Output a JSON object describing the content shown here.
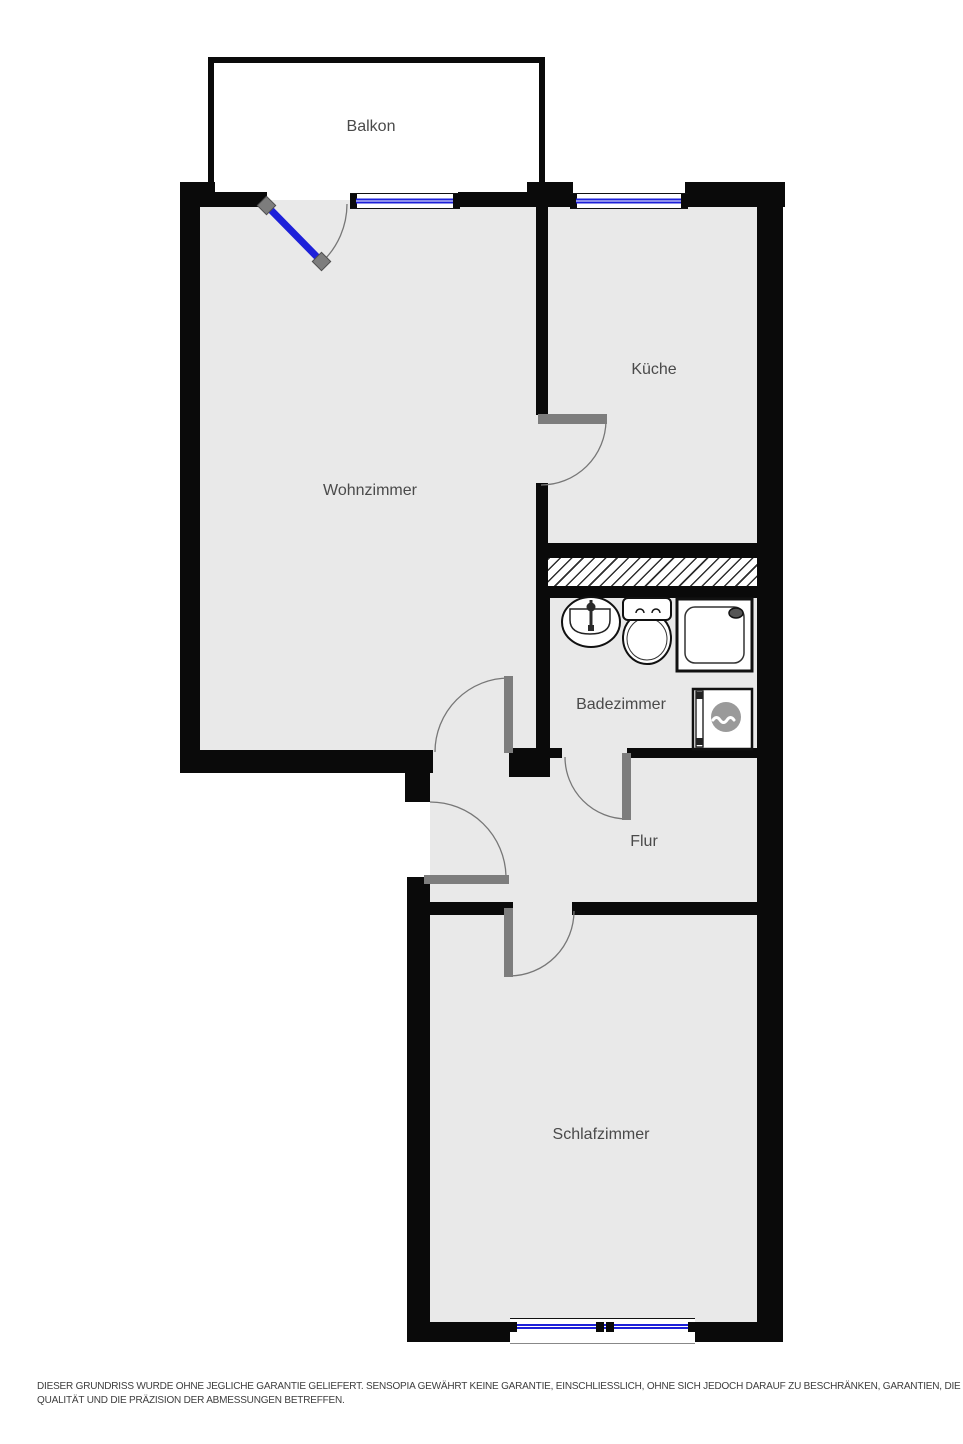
{
  "floorplan": {
    "rooms": [
      {
        "id": "balkon",
        "label": "Balkon"
      },
      {
        "id": "wohnzimmer",
        "label": "Wohnzimmer"
      },
      {
        "id": "kueche",
        "label": "Küche"
      },
      {
        "id": "badezimmer",
        "label": "Badezimmer"
      },
      {
        "id": "flur",
        "label": "Flur"
      },
      {
        "id": "schlafzimmer",
        "label": "Schlafzimmer"
      }
    ],
    "fixtures": [
      {
        "name": "sink"
      },
      {
        "name": "toilet"
      },
      {
        "name": "shower"
      },
      {
        "name": "washing-machine"
      }
    ],
    "features": {
      "windows": [
        "wohnzimmer-top",
        "kueche-top",
        "schlafzimmer-bottom"
      ],
      "doors": [
        "balkon-glass-door",
        "kueche-door",
        "wohnzimmer-door",
        "badezimmer-door",
        "schlafzimmer-door",
        "entrance-door"
      ],
      "shaft": "hatched-duct-between-kueche-and-badezimmer"
    },
    "colors": {
      "wall": "#0a0a0a",
      "floor": "#e9e9e9",
      "door_leaf": "#7d7d7d",
      "window_glass": "#1d20d9",
      "label_text": "#4a4a4a"
    },
    "disclaimer": {
      "line1": "DIESER GRUNDRISS WURDE OHNE JEGLICHE GARANTIE GELIEFERT. SENSOPIA GEWÄHRT KEINE GARANTIE, EINSCHLIESSLICH, OHNE SICH JEDOCH DARAUF ZU BESCHRÄNKEN, GARANTIEN, DIE DIE",
      "line2": "QUALITÄT UND DIE PRÄZISION DER ABMESSUNGEN BETREFFEN."
    }
  }
}
